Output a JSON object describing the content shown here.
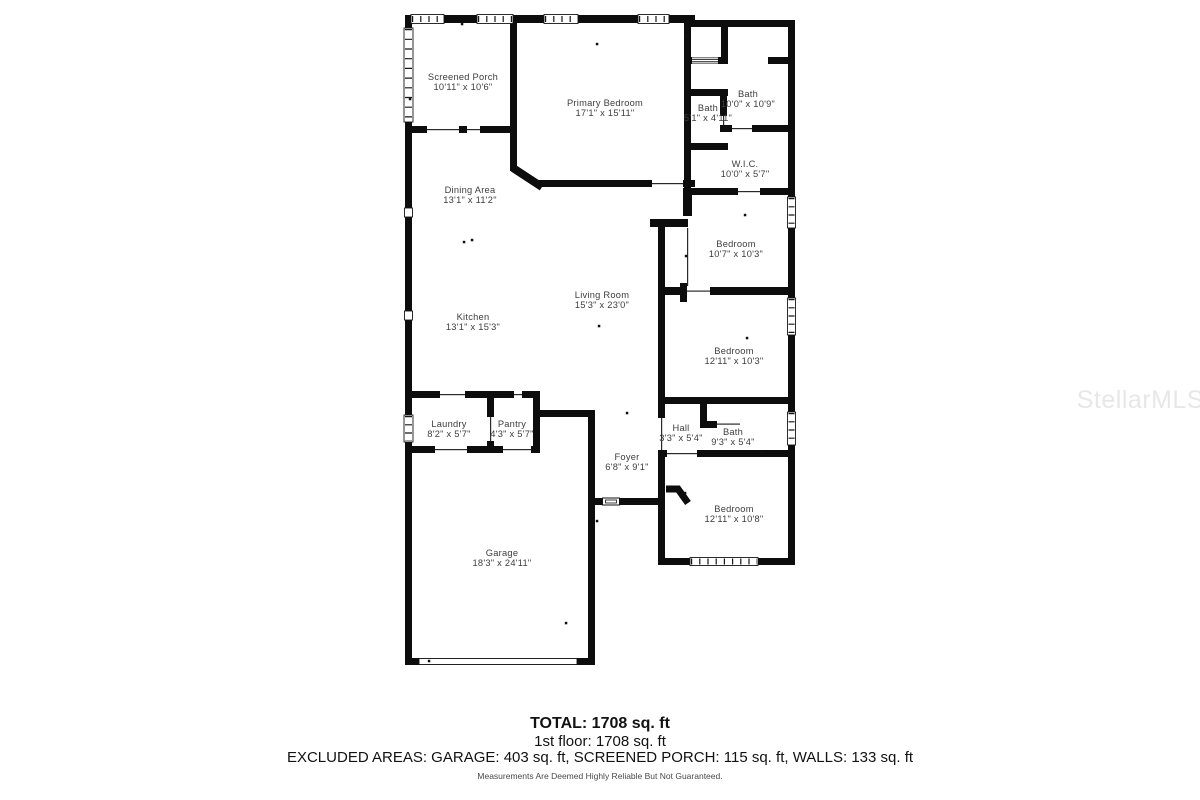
{
  "floorplan": {
    "rooms": [
      {
        "name": "Screened Porch",
        "dims": "10'11\" x 10'6\"",
        "x": 463,
        "y": 82
      },
      {
        "name": "Primary Bedroom",
        "dims": "17'1\" x 15'11\"",
        "x": 605,
        "y": 108
      },
      {
        "name": "Bath",
        "dims": "10'0\" x 10'9\"",
        "x": 748,
        "y": 99
      },
      {
        "name": "Bath",
        "dims": "5'1\" x 4'11\"",
        "x": 708,
        "y": 113
      },
      {
        "name": "W.I.C.",
        "dims": "10'0\" x 5'7\"",
        "x": 745,
        "y": 169
      },
      {
        "name": "Dining Area",
        "dims": "13'1\" x 11'2\"",
        "x": 470,
        "y": 195
      },
      {
        "name": "Bedroom",
        "dims": "10'7\" x 10'3\"",
        "x": 736,
        "y": 249
      },
      {
        "name": "Living Room",
        "dims": "15'3\" x 23'0\"",
        "x": 602,
        "y": 300
      },
      {
        "name": "Kitchen",
        "dims": "13'1\" x 15'3\"",
        "x": 473,
        "y": 322
      },
      {
        "name": "Bedroom",
        "dims": "12'11\" x 10'3\"",
        "x": 734,
        "y": 356
      },
      {
        "name": "Laundry",
        "dims": "8'2\" x 5'7\"",
        "x": 449,
        "y": 429
      },
      {
        "name": "Pantry",
        "dims": "4'3\" x 5'7\"",
        "x": 512,
        "y": 429
      },
      {
        "name": "Hall",
        "dims": "3'3\" x 5'4\"",
        "x": 681,
        "y": 433
      },
      {
        "name": "Bath",
        "dims": "9'3\" x 5'4\"",
        "x": 733,
        "y": 437
      },
      {
        "name": "Foyer",
        "dims": "6'8\" x 9'1\"",
        "x": 627,
        "y": 462
      },
      {
        "name": "Bedroom",
        "dims": "12'11\" x 10'8\"",
        "x": 734,
        "y": 514
      },
      {
        "name": "Garage",
        "dims": "18'3\" x 24'11\"",
        "x": 502,
        "y": 558
      }
    ]
  },
  "footer": {
    "total": "TOTAL: 1708 sq. ft",
    "floor": "1st floor: 1708 sq. ft",
    "excluded": "EXCLUDED AREAS: GARAGE: 403 sq. ft, SCREENED PORCH: 115 sq. ft, WALLS: 133 sq. ft",
    "disclaimer": "Measurements Are Deemed Highly Reliable But Not Guaranteed."
  },
  "watermark": {
    "text": "StellarMLS"
  },
  "colors": {
    "wall": "#0d0d0d",
    "label": "#3d3d3d",
    "watermark": "#e7e7e7"
  }
}
